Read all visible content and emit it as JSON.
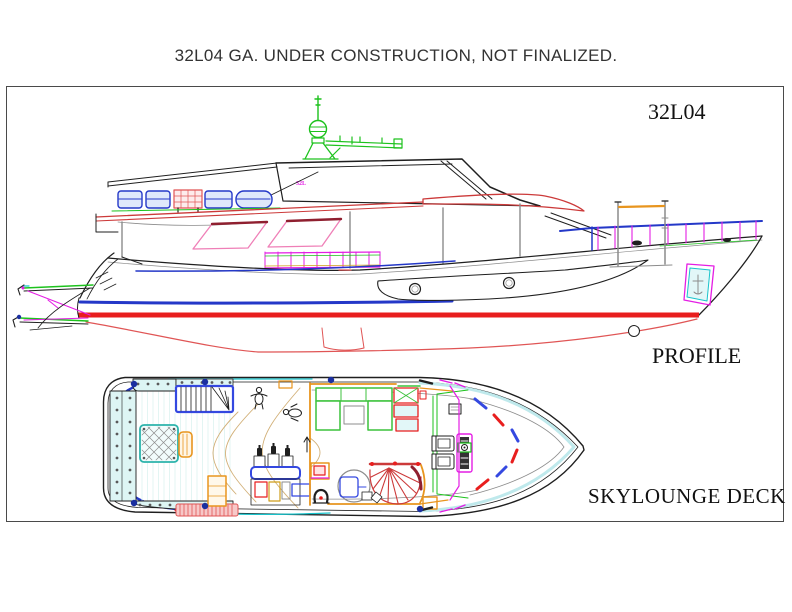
{
  "page": {
    "title": "32L04 GA. UNDER CONSTRUCTION, NOT FINALIZED."
  },
  "frame": {
    "label_model": "32L04",
    "label_profile": "PROFILE",
    "label_deck": "SKYLOUNGE DECK"
  },
  "profile_view": {
    "small_label": "32L",
    "description": "yacht side elevation with radar mast, skylounge, hull waterline and stern passerelle"
  },
  "deck_view": {
    "description": "skylounge deck general arrangement: aft settee and table, staircase, bar, salon sofas, spiral stair, helm station"
  },
  "palette": {
    "ink": "#1f1f1f",
    "gray": "#8c8c8c",
    "ltgray": "#bdbdbd",
    "red": "#e81e1e",
    "softred": "#e05555",
    "deckred": "#cc3a3a",
    "maroon": "#8f1f2f",
    "blue": "#2438c8",
    "navy": "#1b2fa0",
    "royal": "#3448e0",
    "magenta": "#e41ee4",
    "pink": "#ef7fb7",
    "green": "#1dc21d",
    "sofagreen": "#3cc23c",
    "cyan": "#17c3cb",
    "palecyan": "#bfe9ec",
    "palecyanfill": "#e2f7f8",
    "sealight": "#ddf5f4",
    "teal": "#2bb3ab",
    "orange": "#e8951e",
    "amber": "#cf9e1a",
    "tan": "#d2b078",
    "plank": "#e3f5f3",
    "matpink": "#f7c9c9"
  }
}
